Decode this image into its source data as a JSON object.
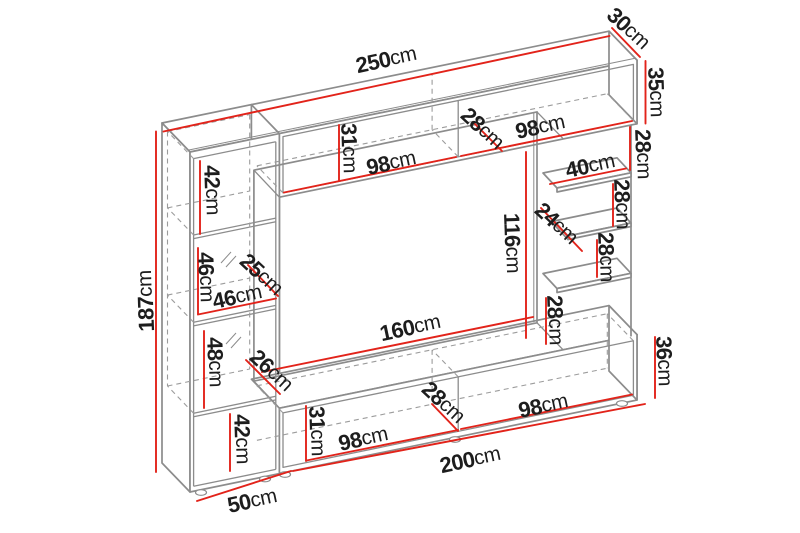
{
  "colors": {
    "dimension": "#e2231a",
    "outline": "#8c8c8c",
    "label": "#1d1d1d",
    "background": "#ffffff"
  },
  "dims": [
    {
      "name": "total-width",
      "value": "250",
      "unit": "cm"
    },
    {
      "name": "top-cabinet-depth",
      "value": "30",
      "unit": "cm"
    },
    {
      "name": "top-cabinet-height",
      "value": "35",
      "unit": "cm"
    },
    {
      "name": "gap-below-top-cabinet",
      "value": "28",
      "unit": "cm"
    },
    {
      "name": "top-right-section-width",
      "value": "98",
      "unit": "cm"
    },
    {
      "name": "top-interior-depth",
      "value": "28",
      "unit": "cm"
    },
    {
      "name": "top-opening-height",
      "value": "31",
      "unit": "cm"
    },
    {
      "name": "top-left-section-width",
      "value": "98",
      "unit": "cm"
    },
    {
      "name": "left-top-compartment-height",
      "value": "42",
      "unit": "cm"
    },
    {
      "name": "left-glass-compartment-height",
      "value": "46",
      "unit": "cm"
    },
    {
      "name": "glass-shelf-depth",
      "value": "25",
      "unit": "cm"
    },
    {
      "name": "left-interior-width",
      "value": "46",
      "unit": "cm"
    },
    {
      "name": "left-lower-compartment-height",
      "value": "48",
      "unit": "cm"
    },
    {
      "name": "left-lower-interior-depth",
      "value": "26",
      "unit": "cm"
    },
    {
      "name": "tv-opening-height",
      "value": "116",
      "unit": "cm"
    },
    {
      "name": "tv-opening-width",
      "value": "160",
      "unit": "cm"
    },
    {
      "name": "shelf-a-width",
      "value": "40",
      "unit": "cm"
    },
    {
      "name": "shelf-b-depth",
      "value": "24",
      "unit": "cm"
    },
    {
      "name": "gap-shelf-a-b",
      "value": "28",
      "unit": "cm"
    },
    {
      "name": "gap-shelf-b-c",
      "value": "28",
      "unit": "cm"
    },
    {
      "name": "gap-shelf-c-bench",
      "value": "28",
      "unit": "cm"
    },
    {
      "name": "bench-height",
      "value": "36",
      "unit": "cm"
    },
    {
      "name": "left-bottom-compartment-height",
      "value": "42",
      "unit": "cm"
    },
    {
      "name": "bench-opening-height",
      "value": "31",
      "unit": "cm"
    },
    {
      "name": "bench-left-section-width",
      "value": "98",
      "unit": "cm"
    },
    {
      "name": "bench-interior-depth",
      "value": "28",
      "unit": "cm"
    },
    {
      "name": "bench-right-section-width",
      "value": "98",
      "unit": "cm"
    },
    {
      "name": "bench-length",
      "value": "200",
      "unit": "cm"
    },
    {
      "name": "left-column-width",
      "value": "50",
      "unit": "cm"
    },
    {
      "name": "total-height",
      "value": "187",
      "unit": "cm"
    }
  ]
}
